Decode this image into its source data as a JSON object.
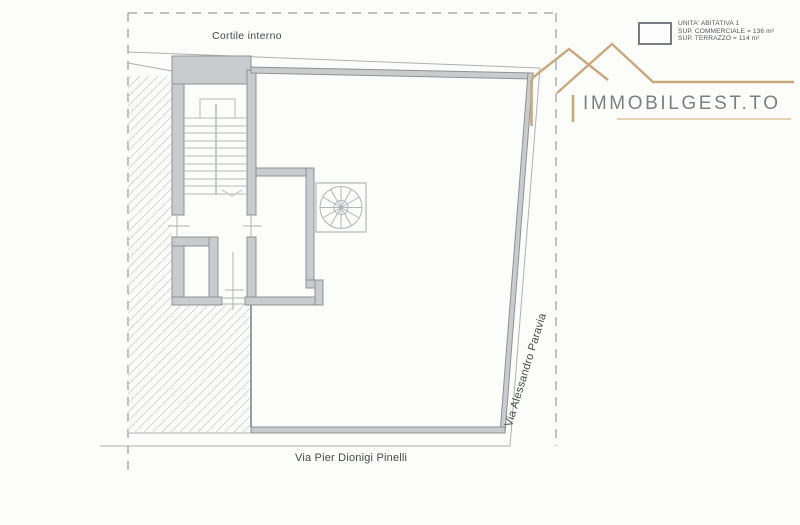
{
  "labels": {
    "courtyard": "Cortile interno",
    "street_bottom": "Via Pier Dionigi Pinelli",
    "street_right": "Via Alessandro Paravia"
  },
  "legend": {
    "unit": "UNITA' ABITATIVA 1",
    "commercial_area": "SUP. COMMERCIALE = 136 m²",
    "terrace_area": "SUP. TERRAZZO = 114 m²"
  },
  "logo": {
    "brand": "IMMOBILGEST.TO"
  },
  "colors": {
    "wall_fill": "#c9cbcc",
    "wall_stroke": "#8f9294",
    "thin_line": "#aeb1b3",
    "dashed_boundary": "#9a9da0",
    "logo_tan": "#c9a87d",
    "logo_text": "#7c8083",
    "label_text": "#46494b"
  }
}
